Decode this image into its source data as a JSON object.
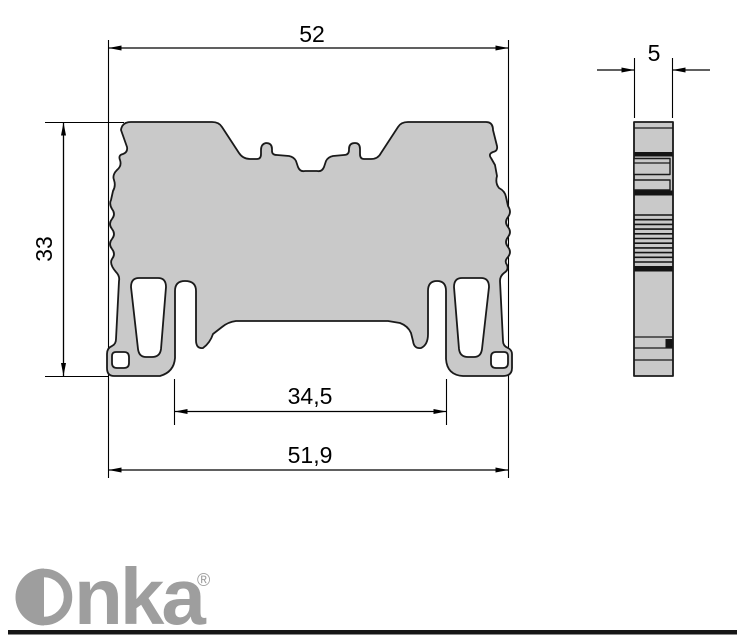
{
  "drawing": {
    "type": "technical-dimension-drawing",
    "views": {
      "front": "terminal-block-front-profile",
      "side": "terminal-block-side-profile"
    },
    "dimensions": {
      "top_width": "52",
      "height": "33",
      "rail_slot_width": "34,5",
      "bottom_width": "51,9",
      "thickness": "5"
    },
    "colors": {
      "part_fill": "#c9c9c9",
      "part_outline": "#1a1a1a",
      "dimension_line": "#000000",
      "logo_gray": "#9e9e9e",
      "divider": "#161616"
    }
  },
  "logo": {
    "brand": "Onka",
    "text_after_o": "nka",
    "registered_mark": "®"
  }
}
